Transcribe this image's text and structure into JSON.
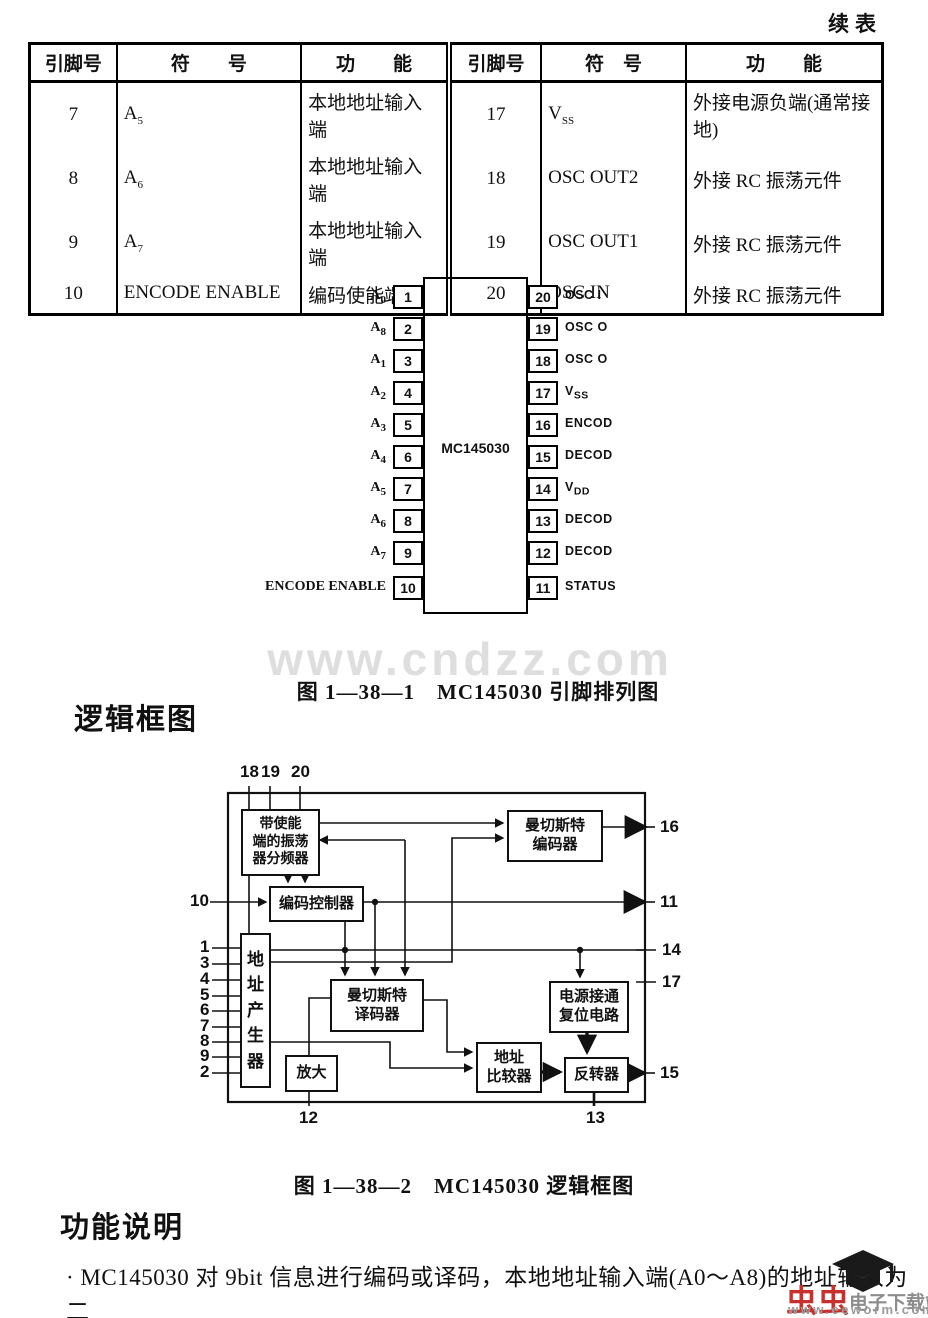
{
  "page": {
    "continued_label": "续表",
    "watermark": "www.cndzz.com",
    "fig1_caption": "图 1—38—1　MC145030 引脚排列图",
    "section_logic_title": "逻辑框图",
    "fig2_caption": "图 1—38—2　MC145030 逻辑框图",
    "section_function_title": "功能说明",
    "body_text": "· MC145030 对 9bit 信息进行编码或译码，本地地址输入端(A0～A8)的地址输入为二"
  },
  "pin_table": {
    "left": {
      "headers": [
        "引脚号",
        "符　　号",
        "功　　能"
      ],
      "rows": [
        {
          "pin": "7",
          "sym_base": "A",
          "sym_sub": "5",
          "func": "本地地址输入端"
        },
        {
          "pin": "8",
          "sym_base": "A",
          "sym_sub": "6",
          "func": "本地地址输入端"
        },
        {
          "pin": "9",
          "sym_base": "A",
          "sym_sub": "7",
          "func": "本地地址输入端"
        },
        {
          "pin": "10",
          "sym_base": "ENCODE ENABLE",
          "sym_sub": "",
          "func": "编码使能端"
        }
      ]
    },
    "right": {
      "headers": [
        "引脚号",
        "符　号",
        "功　　能"
      ],
      "rows": [
        {
          "pin": "17",
          "sym_base": "V",
          "sym_sub": "SS",
          "func": "外接电源负端(通常接地)"
        },
        {
          "pin": "18",
          "sym_base": "OSC OUT2",
          "sym_sub": "",
          "func": "外接 RC 振荡元件"
        },
        {
          "pin": "19",
          "sym_base": "OSC OUT1",
          "sym_sub": "",
          "func": "外接 RC 振荡元件"
        },
        {
          "pin": "20",
          "sym_base": "OSC IN",
          "sym_sub": "",
          "func": "外接 RC 振荡元件"
        }
      ]
    }
  },
  "chip": {
    "name": "MC145030",
    "left_pins": [
      {
        "num": "1",
        "base": "A",
        "sub": "0"
      },
      {
        "num": "2",
        "base": "A",
        "sub": "8"
      },
      {
        "num": "3",
        "base": "A",
        "sub": "1"
      },
      {
        "num": "4",
        "base": "A",
        "sub": "2"
      },
      {
        "num": "5",
        "base": "A",
        "sub": "3"
      },
      {
        "num": "6",
        "base": "A",
        "sub": "4"
      },
      {
        "num": "7",
        "base": "A",
        "sub": "5"
      },
      {
        "num": "8",
        "base": "A",
        "sub": "6"
      },
      {
        "num": "9",
        "base": "A",
        "sub": "7"
      },
      {
        "num": "10",
        "base": "ENCODE ENABLE",
        "sub": ""
      }
    ],
    "right_pins": [
      {
        "num": "20",
        "base": "OSC I",
        "sub": ""
      },
      {
        "num": "19",
        "base": "OSC O",
        "sub": ""
      },
      {
        "num": "18",
        "base": "OSC O",
        "sub": ""
      },
      {
        "num": "17",
        "base": "V",
        "sub": "SS"
      },
      {
        "num": "16",
        "base": "ENCOD",
        "sub": ""
      },
      {
        "num": "15",
        "base": "DECOD",
        "sub": ""
      },
      {
        "num": "14",
        "base": "V",
        "sub": "DD"
      },
      {
        "num": "13",
        "base": "DECOD",
        "sub": ""
      },
      {
        "num": "12",
        "base": "DECOD",
        "sub": ""
      },
      {
        "num": "11",
        "base": "STATUS",
        "sub": ""
      }
    ]
  },
  "logic": {
    "top_pins": [
      "18",
      "19",
      "20"
    ],
    "pin10": "10",
    "left_pins": [
      "1",
      "3",
      "4",
      "5",
      "6",
      "7",
      "8",
      "9",
      "2"
    ],
    "right_pins": {
      "p16": "16",
      "p11": "11",
      "p14": "14",
      "p17": "17",
      "p15": "15"
    },
    "bottom_pins": {
      "p12": "12",
      "p13": "13"
    },
    "blocks": {
      "osc": "带使能\n端的振荡\n器分频器",
      "encoder": "曼切斯特\n编码器",
      "ctrl": "编码控制器",
      "addrgen": "地址产生器",
      "decoder": "曼切斯特\n译码器",
      "reset": "电源接通\n复位电路",
      "amp": "放大",
      "comparator": "地址\n比较器",
      "inverter": "反转器"
    }
  },
  "footer_logo": {
    "brand": "虫虫",
    "site": "电子下载站",
    "url": "www.eeworm.com"
  }
}
